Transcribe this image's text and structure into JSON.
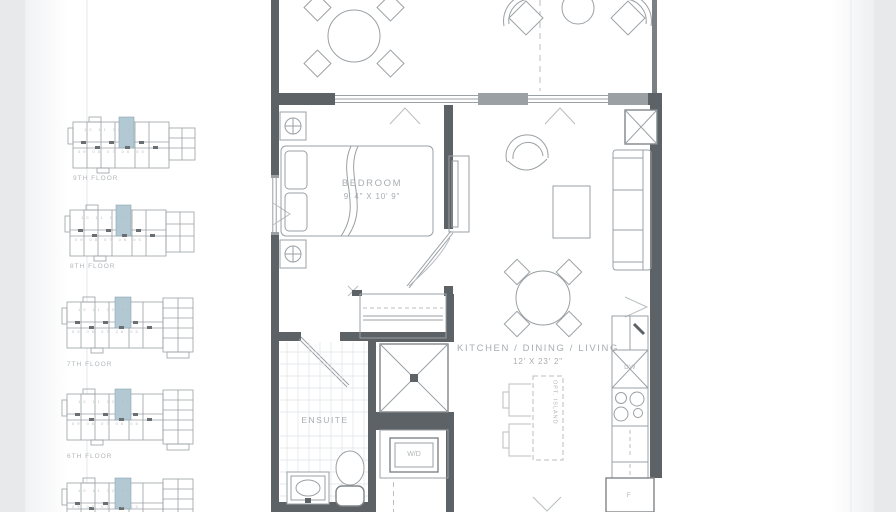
{
  "keyplans": {
    "floors": [
      {
        "label": "9TH FLOOR"
      },
      {
        "label": "8TH FLOOR"
      },
      {
        "label": "7TH FLOOR"
      },
      {
        "label": "6TH FLOOR"
      },
      {
        "label": ""
      }
    ],
    "units_top": "10 11 02 03",
    "units_bottom": "09 08 07 06 05",
    "highlight_color": "#b2c8d3"
  },
  "plan": {
    "bedroom": {
      "label": "BEDROOM",
      "dims": "9' 4\" X 10' 9\""
    },
    "main_room": {
      "label": "KITCHEN / DINING / LIVING",
      "dims": "12' X 23' 2\""
    },
    "ensuite": {
      "label": "ENSUITE"
    },
    "laundry": {
      "label": "W/D"
    },
    "dishwasher": {
      "label": "DW"
    },
    "fridge": {
      "label": "F"
    },
    "island": {
      "label": "OPT. ISLAND"
    }
  },
  "colors": {
    "wall": "#5d6266",
    "line": "#9aa0a4",
    "light_line": "#c6cacc",
    "text": "#a8adb0",
    "backdrop": "#e8e9eb",
    "sheet": "#ffffff"
  }
}
